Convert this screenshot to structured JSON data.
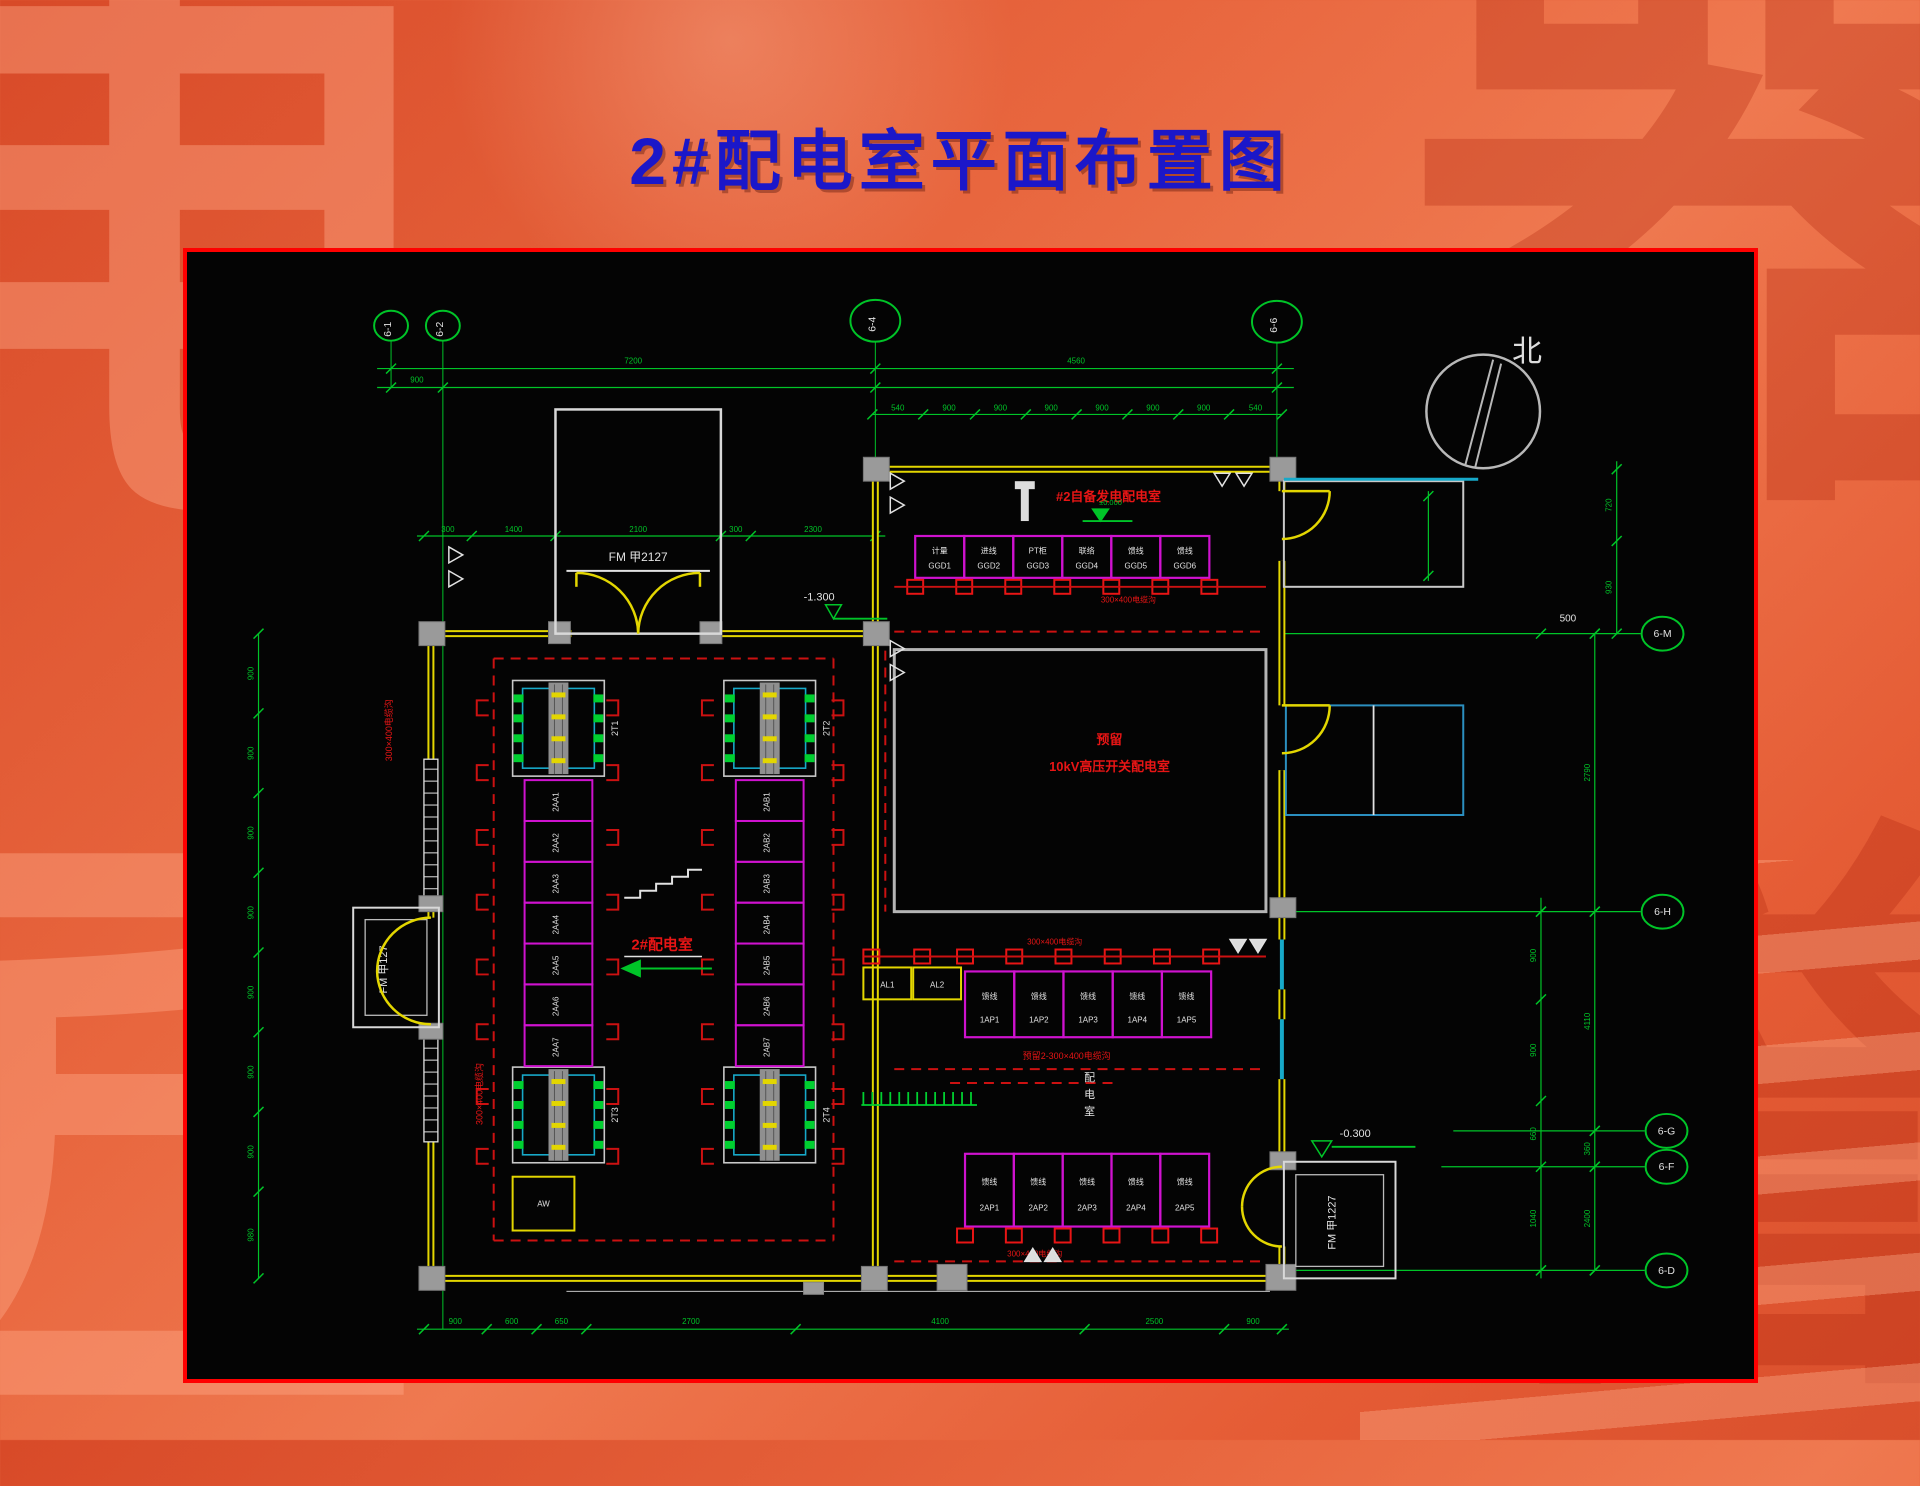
{
  "slide": {
    "title": "2#配电室平面布置图"
  },
  "background": {
    "glyphs": [
      "电",
      "器",
      "匠",
      "誉"
    ]
  },
  "compass": {
    "label": "北"
  },
  "grid": {
    "top": [
      "6-1",
      "6-2",
      "6-4",
      "6-6"
    ],
    "right": [
      "6-M",
      "6-H",
      "6-G",
      "6-F",
      "6-D"
    ]
  },
  "dims": {
    "top1": [
      "7200",
      "4560"
    ],
    "top2": [
      "900",
      "",
      ""
    ],
    "window_row": [
      "540",
      "900",
      "900",
      "900",
      "900",
      "900",
      "900",
      "540"
    ],
    "inner_top": [
      "300",
      "1400",
      "2100",
      "300",
      "2300"
    ],
    "bottom": [
      "900",
      "600",
      "650",
      "2700",
      "4100",
      "2500",
      "900"
    ],
    "left": [
      "900",
      "900",
      "900",
      "900",
      "900",
      "900",
      "900",
      "980"
    ],
    "right_a": [
      "900",
      "900",
      "660",
      "1040"
    ],
    "right_b": [
      "2790",
      "4110",
      "360",
      "2400"
    ],
    "right_c": [
      "720",
      "930"
    ],
    "offset_500": "500"
  },
  "elevations": {
    "top_entry": "-1.300",
    "gen_room": "±0.000",
    "exit": "-0.300"
  },
  "doors": {
    "top": "FM 甲2127",
    "left": "FM 甲127",
    "bottom_right": "FM 甲1227"
  },
  "rooms": {
    "lv_room": {
      "label": "2#配电室",
      "transformer_tags": [
        "2T1",
        "2T2",
        "2T3",
        "2T4"
      ],
      "aux_box": "AW",
      "trench_left": "300×400电缆沟",
      "trench_inner": "300×400电缆沟"
    },
    "gen_room": {
      "label": "#2自备发电配电室",
      "trench": "300×400电缆沟"
    },
    "hv_room": {
      "label_1": "预留",
      "label_2": "10kV高压开关配电室"
    },
    "lv_south": {
      "label_vertical": "配电室",
      "trench_top": "300×400电缆沟",
      "trench_mid": "预留2-300×400电缆沟",
      "trench_bottom": "300×400电缆沟"
    }
  },
  "panels": {
    "gen_row": [
      {
        "l1": "计量",
        "l2": "GGD1"
      },
      {
        "l1": "进线",
        "l2": "GGD2"
      },
      {
        "l1": "PT柜",
        "l2": "GGD3"
      },
      {
        "l1": "联络",
        "l2": "GGD4"
      },
      {
        "l1": "馈线",
        "l2": "GGD5"
      },
      {
        "l1": "馈线",
        "l2": "GGD6"
      }
    ],
    "mid_row": [
      {
        "l1": "馈线",
        "l2": "1AP1"
      },
      {
        "l1": "馈线",
        "l2": "1AP2"
      },
      {
        "l1": "馈线",
        "l2": "1AP3"
      },
      {
        "l1": "馈线",
        "l2": "1AP4"
      },
      {
        "l1": "馈线",
        "l2": "1AP5"
      }
    ],
    "south_row": [
      {
        "l1": "馈线",
        "l2": "2AP1"
      },
      {
        "l1": "馈线",
        "l2": "2AP2"
      },
      {
        "l1": "馈线",
        "l2": "2AP3"
      },
      {
        "l1": "馈线",
        "l2": "2AP4"
      },
      {
        "l1": "馈线",
        "l2": "2AP5"
      }
    ],
    "feeder_boxes": [
      "AL1",
      "AL2"
    ],
    "col_a": [
      "2AA1",
      "2AA2",
      "2AA3",
      "2AA4",
      "2AA5",
      "2AA6",
      "2AA7"
    ],
    "col_b": [
      "2AB1",
      "2AB2",
      "2AB3",
      "2AB4",
      "2AB5",
      "2AB6",
      "2AB7"
    ]
  }
}
